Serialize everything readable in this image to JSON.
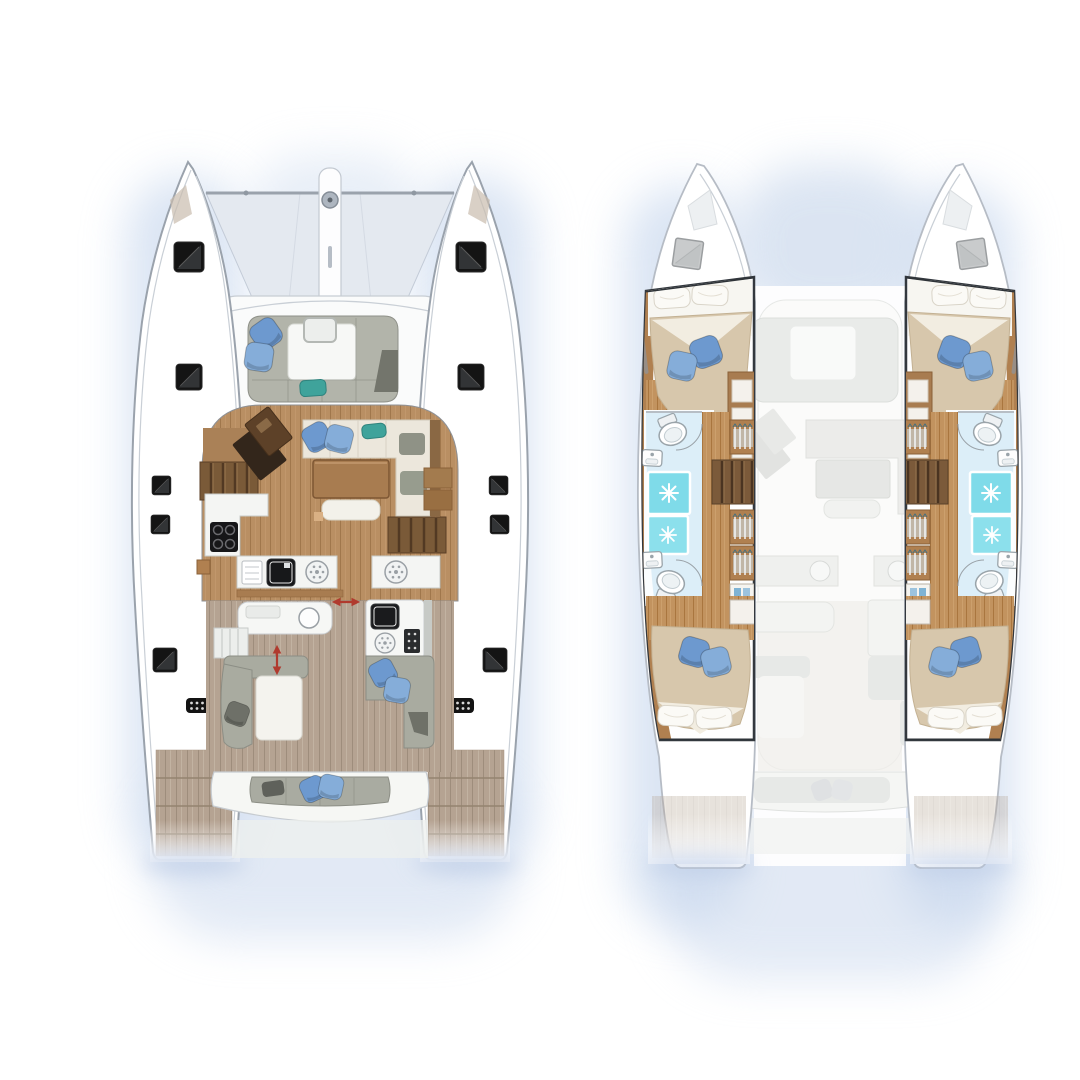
{
  "page": {
    "aria": "Catamaran yacht floor plan with two top-down views: main deck plan and hull accommodation plan",
    "background": "#ffffff"
  },
  "palette": {
    "hull_white": "#ffffff",
    "hull_outline": "#9aa2ac",
    "cabin_outline": "#2e3338",
    "halo_blue": "#bccfea",
    "trampoline": "#e4e9f0",
    "salon_wood": "#b98f63",
    "cabin_wood": "#c2935f",
    "cockpit_deck": "#b5a392",
    "step_wood": "#7a5a38",
    "table_wood": "#a87c50",
    "nav_desk_dark": "#33261b",
    "cushion_gray": "#aaaca1",
    "cushion_cream": "#ece7dc",
    "pillow_blue": "#6d99cf",
    "pillow_blue_light": "#85add9",
    "pillow_teal": "#3fa39b",
    "pillow_dark": "#6e7068",
    "bath_floor": "#d8ecf7",
    "shower_teal": "#7fdbe9",
    "duvet_tan": "#d7c7ac",
    "hatch_black": "#141414",
    "arrow_red": "#b03a2e",
    "ghost_gray": "#e8eae8"
  },
  "views": {
    "deck_plan": {
      "aria": "Main deck plan (left view)",
      "features": [
        {
          "name": "bow-trampoline"
        },
        {
          "name": "anchor-locker-spine"
        },
        {
          "name": "mast-fitting"
        },
        {
          "name": "forward-cockpit-lounge",
          "pillows": {
            "blue": 2,
            "teal": 1
          }
        },
        {
          "name": "salon"
        },
        {
          "name": "nav-station"
        },
        {
          "name": "salon-sofa",
          "pillows": {
            "blue": 2,
            "teal": 1
          }
        },
        {
          "name": "dining-table"
        },
        {
          "name": "galley",
          "appliances": [
            "cooktop",
            "black-sink",
            "round-hob",
            "dish-drawer",
            "second-hob"
          ]
        },
        {
          "name": "companionway-steps",
          "count": 2
        },
        {
          "name": "aft-cockpit"
        },
        {
          "name": "outdoor-galley",
          "appliances": [
            "grill-sink",
            "round-burner",
            "control-panel"
          ]
        },
        {
          "name": "cockpit-lounge-port",
          "pillows": {
            "dark": 1
          }
        },
        {
          "name": "cockpit-lounge-starboard",
          "pillows": {
            "blue": 2
          }
        },
        {
          "name": "aft-bench",
          "pillows": {
            "blue": 2,
            "dark": 1
          }
        },
        {
          "name": "swim-platform",
          "count": 2
        },
        {
          "name": "deck-hatch",
          "count": 10
        },
        {
          "name": "vent-grille",
          "count": 2
        },
        {
          "name": "passage-arrow",
          "count": 2,
          "color": "#b03a2e"
        }
      ]
    },
    "accommodation_plan": {
      "aria": "Hull accommodation plan (right view)",
      "cabins": {
        "count": 4,
        "pillows_per_cabin": {
          "blue": 2,
          "white": 2
        }
      },
      "bathrooms": {
        "count": 4,
        "showers": 4,
        "toilets": 4,
        "sinks": 4
      },
      "features": [
        {
          "name": "forward-cabin-port"
        },
        {
          "name": "forward-cabin-starboard"
        },
        {
          "name": "aft-cabin-port"
        },
        {
          "name": "aft-cabin-starboard"
        },
        {
          "name": "bathroom-with-shower",
          "count": 4
        },
        {
          "name": "wardrobe-hanging-locker",
          "count": 6
        },
        {
          "name": "companionway-stairs",
          "count": 2
        },
        {
          "name": "bow-locker-hatch",
          "count": 2
        },
        {
          "name": "ghosted-main-deck-overlay"
        }
      ]
    }
  }
}
